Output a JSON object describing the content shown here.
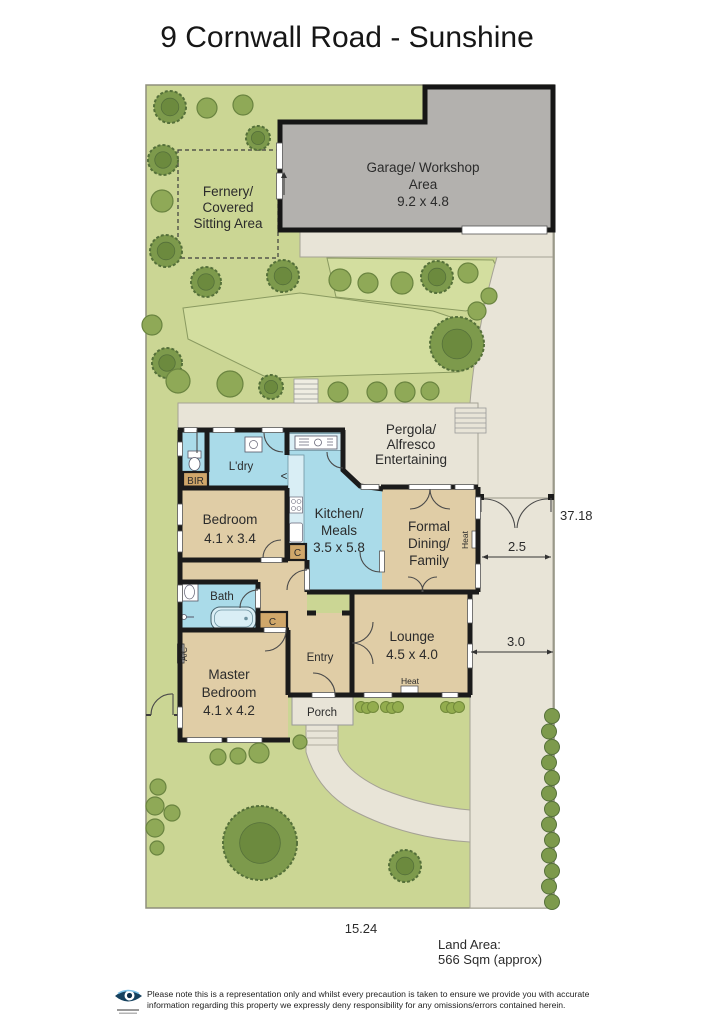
{
  "title": "9 Cornwall Road - Sunshine",
  "plan": {
    "garage": {
      "line1": "Garage/ Workshop",
      "line2": "Area",
      "line3": "9.2 x 4.8"
    },
    "fernery": {
      "line1": "Fernery/",
      "line2": "Covered",
      "line3": "Sitting Area"
    },
    "pergola": {
      "line1": "Pergola/",
      "line2": "Alfresco",
      "line3": "Entertaining"
    },
    "bedroom": {
      "line1": "Bedroom",
      "line2": "4.1 x 3.4"
    },
    "kitchen": {
      "line1": "Kitchen/",
      "line2": "Meals",
      "line3": "3.5 x 5.8"
    },
    "dining": {
      "line1": "Formal",
      "line2": "Dining/",
      "line3": "Family"
    },
    "lounge": {
      "line1": "Lounge",
      "line2": "4.5 x 4.0"
    },
    "master": {
      "line1": "Master",
      "line2": "Bedroom",
      "line3": "4.1 x 4.2"
    },
    "laundry": "L'dry",
    "bath": "Bath",
    "entry": "Entry",
    "porch": "Porch",
    "bir": "BIR",
    "closet": "C",
    "ac": "A/C",
    "heat": "Heat",
    "fridge_marker": "<"
  },
  "dimensions": {
    "boundary_right": "37.18",
    "gate_width": "2.5",
    "side_setback": "3.0",
    "frontage": "15.24"
  },
  "land_area": {
    "line1": "Land Area:",
    "line2": "566 Sqm (approx)"
  },
  "footer": {
    "disclaimer_line1": "Please note this is a representation only and whilst every precaution is taken to ensure we provide you with accurate",
    "disclaimer_line2": "information regarding this property we expressly deny responsibility for any omissions/errors contained herein."
  },
  "colors": {
    "lawn": "#cbd694",
    "garden_bed": "#d3de9f",
    "paving": "#e8e4d7",
    "garage": "#b3b1ae",
    "room_tan": "#e0cda6",
    "room_blue": "#aadbe9",
    "closet_tan": "#d0a76a",
    "wall": "#1b1b1b",
    "tree": "#7d9a4c",
    "tree_dark": "#55703a"
  }
}
